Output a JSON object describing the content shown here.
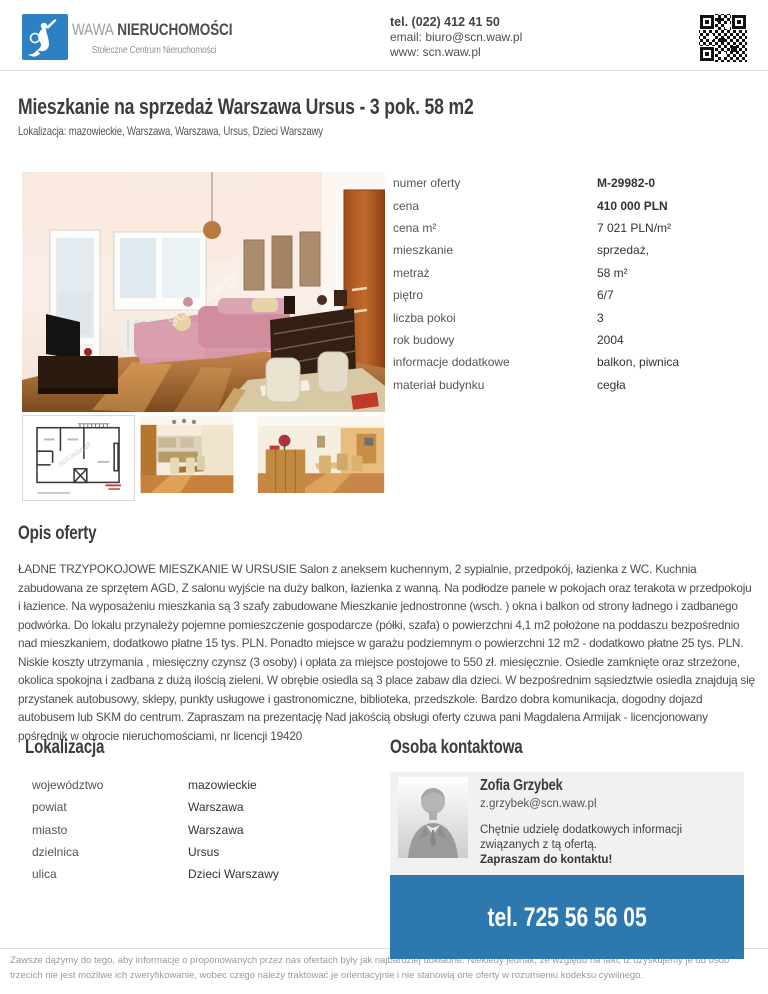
{
  "colors": {
    "accent_blue": "#2e78b0",
    "logo_blue": "#2e80c4"
  },
  "watermark": "scn.waw.pl",
  "header": {
    "brand_wawa": "WAWA",
    "brand_name": "NIERUCHOMOŚCI",
    "brand_subtitle": "Stołeczne Centrum Nieruchomości",
    "phone": "tel. (022) 412 41 50",
    "email": "email: biuro@scn.waw.pl",
    "www": "www: scn.waw.pl"
  },
  "listing": {
    "title": "Mieszkanie na sprzedaż Warszawa Ursus - 3 pok. 58 m2",
    "location_line": "Lokalizacja: mazowieckie, Warszawa, Warszawa, Ursus, Dzieci Warszawy"
  },
  "details": {
    "rows": [
      {
        "label": "numer oferty",
        "value": "M-29982-0",
        "value_bold": true
      },
      {
        "label": "cena",
        "value": "410 000 PLN",
        "value_bold": true
      },
      {
        "label": "cena m²",
        "value": "7 021 PLN/m²"
      },
      {
        "label": "mieszkanie",
        "value": "sprzedaż,"
      },
      {
        "label": "metraż",
        "value": "58 m²"
      },
      {
        "label": "piętro",
        "value": "6/7"
      },
      {
        "label": "liczba pokoi",
        "value": "3"
      },
      {
        "label": "rok budowy",
        "value": "2004"
      },
      {
        "label": "informacje dodatkowe",
        "value": "balkon, piwnica"
      },
      {
        "label": "materiał budynku",
        "value": "cegła"
      }
    ]
  },
  "description": {
    "heading": "Opis oferty",
    "text": "ŁADNE TRZYPOKOJOWE MIESZKANIE W URSUSIE Salon z aneksem kuchennym, 2 sypialnie, przedpokój, łazienka z WC. Kuchnia zabudowana ze sprzętem AGD, Z salonu wyjście na duży balkon, łazienka z wanną. Na podłodze panele w pokojach oraz terakota w przedpokoju i łazience. Na wyposażeniu mieszkania są 3 szafy zabudowane Mieszkanie jednostronne (wsch. ) okna i balkon od strony ładnego i zadbanego podwórka. Do lokalu przynależy pojemne pomieszczenie gospodarcze (półki, szafa) o powierzchni 4,1 m2 położone na poddaszu bezpośrednio nad mieszkaniem, dodatkowo płatne 15 tys. PLN. Ponadto miejsce w garażu podziemnym o powierzchni 12 m2 - dodatkowo płatne 25 tys. PLN. Niskie koszty utrzymania , miesięczny czynsz (3 osoby) i opłata za miejsce postojowe to 550 zł. miesięcznie. Osiedle zamknięte oraz strzeżone, okolica spokojna i zadbana z dużą ilością zieleni. W obrębie osiedla są 3 place zabaw dla dzieci. W bezpośrednim sąsiedztwie osiedla znajdują się przystanek autobusowy, sklepy, punkty usługowe i gastronomiczne, biblioteka, przedszkole. Bardzo dobra komunikacja, dogodny dojazd autobusem lub SKM do centrum. Zapraszam na prezentację Nad jakością obsługi oferty czuwa pani Magdalena Armijak - licencjonowany pośrednik w obrocie nieruchomościami, nr licencji 19420"
  },
  "location": {
    "heading": "Lokalizacja",
    "rows": [
      {
        "label": "województwo",
        "value": "mazowieckie"
      },
      {
        "label": "powiat",
        "value": "Warszawa"
      },
      {
        "label": "miasto",
        "value": "Warszawa"
      },
      {
        "label": "dzielnica",
        "value": "Ursus"
      },
      {
        "label": "ulica",
        "value": "Dzieci Warszawy"
      }
    ]
  },
  "agent": {
    "heading": "Osoba kontaktowa",
    "name": "Zofia Grzybek",
    "email": "z.grzybek@scn.waw.pl",
    "message": "Chętnie udzielę dodatkowych informacji związanych z tą ofertą.",
    "message_bold": "Zapraszam do kontaktu!",
    "phone": "tel. 725 56 56 05"
  },
  "footer": {
    "disclaimer": "Zawsze dążymy do tego, aby informacje o proponowanych przez nas ofertach były jak najbardziej dokładne. Niekiedy jednak, ze względu na fakt, iż uzyskujemy je od osób trzecich nie jest możliwe ich zweryfikowanie, wobec czego należy traktować je orientacyjnie i nie stanowią one oferty w rozumieniu kodeksu cywilnego."
  }
}
